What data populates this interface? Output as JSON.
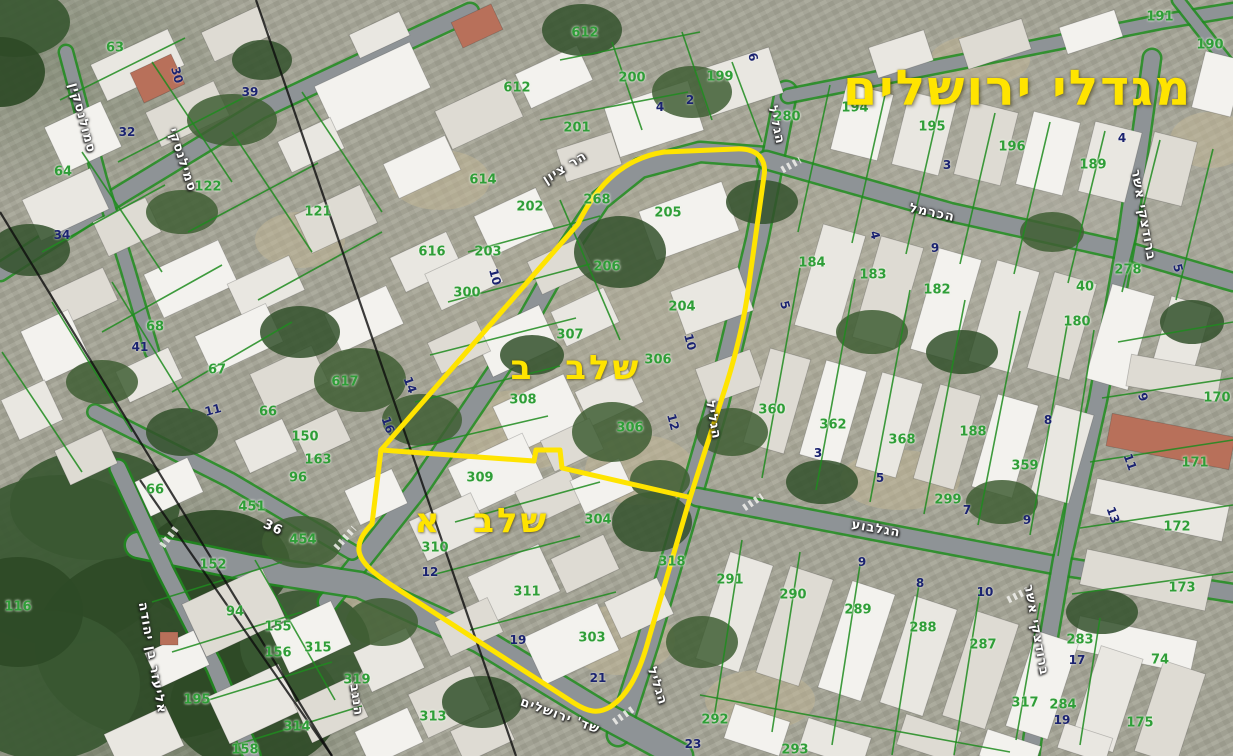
{
  "title": {
    "text": "מגדלי ירושלים"
  },
  "phase_labels": [
    {
      "text": "שלב ב",
      "x": 576,
      "y": 368
    },
    {
      "text": "שלב א",
      "x": 482,
      "y": 521
    }
  ],
  "street_labels": [
    {
      "text": "הר ציון",
      "x": 565,
      "y": 168,
      "rot": -32
    },
    {
      "text": "הגליל",
      "x": 776,
      "y": 125,
      "rot": 78
    },
    {
      "text": "הגליל",
      "x": 713,
      "y": 420,
      "rot": 80
    },
    {
      "text": "הגליל",
      "x": 657,
      "y": 686,
      "rot": 72
    },
    {
      "text": "הכרמל",
      "x": 932,
      "y": 213,
      "rot": 12
    },
    {
      "text": "הגלבוע",
      "x": 876,
      "y": 529,
      "rot": 10
    },
    {
      "text": "סמילנסקי",
      "x": 182,
      "y": 160,
      "rot": 72
    },
    {
      "text": "סמולנסקין",
      "x": 82,
      "y": 118,
      "rot": 75
    },
    {
      "text": "אליעזר בן יהודה",
      "x": 152,
      "y": 658,
      "rot": 80
    },
    {
      "text": "שד' ירושלים",
      "x": 560,
      "y": 716,
      "rot": 20
    },
    {
      "text": "הנגב",
      "x": 356,
      "y": 700,
      "rot": 82
    },
    {
      "text": "ברודצקי אשר",
      "x": 1143,
      "y": 215,
      "rot": 80
    },
    {
      "text": "ברודצקי אשר",
      "x": 1036,
      "y": 630,
      "rot": 80
    },
    {
      "text": "36",
      "x": 273,
      "y": 528,
      "rot": 25
    }
  ],
  "parcel_numbers": [
    {
      "text": "63",
      "x": 115,
      "y": 48
    },
    {
      "text": "64",
      "x": 63,
      "y": 172
    },
    {
      "text": "122",
      "x": 208,
      "y": 187
    },
    {
      "text": "121",
      "x": 318,
      "y": 212
    },
    {
      "text": "68",
      "x": 155,
      "y": 327
    },
    {
      "text": "67",
      "x": 217,
      "y": 370
    },
    {
      "text": "66",
      "x": 268,
      "y": 412
    },
    {
      "text": "66",
      "x": 155,
      "y": 490
    },
    {
      "text": "150",
      "x": 305,
      "y": 437
    },
    {
      "text": "617",
      "x": 345,
      "y": 382
    },
    {
      "text": "163",
      "x": 318,
      "y": 460
    },
    {
      "text": "96",
      "x": 298,
      "y": 478
    },
    {
      "text": "152",
      "x": 213,
      "y": 565
    },
    {
      "text": "116",
      "x": 18,
      "y": 607
    },
    {
      "text": "94",
      "x": 235,
      "y": 612
    },
    {
      "text": "155",
      "x": 278,
      "y": 627
    },
    {
      "text": "156",
      "x": 278,
      "y": 653
    },
    {
      "text": "195",
      "x": 197,
      "y": 700
    },
    {
      "text": "315",
      "x": 318,
      "y": 648
    },
    {
      "text": "314",
      "x": 297,
      "y": 727
    },
    {
      "text": "313",
      "x": 433,
      "y": 717
    },
    {
      "text": "319",
      "x": 357,
      "y": 680
    },
    {
      "text": "318",
      "x": 672,
      "y": 562
    },
    {
      "text": "158",
      "x": 245,
      "y": 750
    },
    {
      "text": "451",
      "x": 252,
      "y": 507
    },
    {
      "text": "454",
      "x": 303,
      "y": 540
    },
    {
      "text": "612",
      "x": 585,
      "y": 33
    },
    {
      "text": "612",
      "x": 517,
      "y": 88
    },
    {
      "text": "200",
      "x": 632,
      "y": 78
    },
    {
      "text": "199",
      "x": 720,
      "y": 77
    },
    {
      "text": "201",
      "x": 577,
      "y": 128
    },
    {
      "text": "280",
      "x": 787,
      "y": 117
    },
    {
      "text": "194",
      "x": 855,
      "y": 108
    },
    {
      "text": "195",
      "x": 932,
      "y": 127
    },
    {
      "text": "196",
      "x": 1012,
      "y": 147
    },
    {
      "text": "189",
      "x": 1093,
      "y": 165
    },
    {
      "text": "191",
      "x": 1160,
      "y": 17
    },
    {
      "text": "190",
      "x": 1210,
      "y": 45
    },
    {
      "text": "614",
      "x": 483,
      "y": 180
    },
    {
      "text": "202",
      "x": 530,
      "y": 207
    },
    {
      "text": "268",
      "x": 597,
      "y": 200
    },
    {
      "text": "205",
      "x": 668,
      "y": 213
    },
    {
      "text": "616",
      "x": 432,
      "y": 252
    },
    {
      "text": "203",
      "x": 488,
      "y": 252
    },
    {
      "text": "206",
      "x": 607,
      "y": 267
    },
    {
      "text": "300",
      "x": 467,
      "y": 293
    },
    {
      "text": "204",
      "x": 682,
      "y": 307
    },
    {
      "text": "307",
      "x": 570,
      "y": 335
    },
    {
      "text": "306",
      "x": 658,
      "y": 360
    },
    {
      "text": "308",
      "x": 523,
      "y": 400
    },
    {
      "text": "306",
      "x": 630,
      "y": 428
    },
    {
      "text": "309",
      "x": 480,
      "y": 478
    },
    {
      "text": "310",
      "x": 435,
      "y": 548
    },
    {
      "text": "311",
      "x": 527,
      "y": 592
    },
    {
      "text": "304",
      "x": 598,
      "y": 520
    },
    {
      "text": "303",
      "x": 592,
      "y": 638
    },
    {
      "text": "360",
      "x": 772,
      "y": 410
    },
    {
      "text": "362",
      "x": 833,
      "y": 425
    },
    {
      "text": "368",
      "x": 902,
      "y": 440
    },
    {
      "text": "188",
      "x": 973,
      "y": 432
    },
    {
      "text": "359",
      "x": 1025,
      "y": 466
    },
    {
      "text": "299",
      "x": 948,
      "y": 500
    },
    {
      "text": "184",
      "x": 812,
      "y": 263
    },
    {
      "text": "183",
      "x": 873,
      "y": 275
    },
    {
      "text": "182",
      "x": 937,
      "y": 290
    },
    {
      "text": "180",
      "x": 1077,
      "y": 322
    },
    {
      "text": "40",
      "x": 1085,
      "y": 287
    },
    {
      "text": "278",
      "x": 1128,
      "y": 270
    },
    {
      "text": "170",
      "x": 1217,
      "y": 398
    },
    {
      "text": "171",
      "x": 1195,
      "y": 463
    },
    {
      "text": "172",
      "x": 1177,
      "y": 527
    },
    {
      "text": "173",
      "x": 1182,
      "y": 588
    },
    {
      "text": "291",
      "x": 730,
      "y": 580
    },
    {
      "text": "290",
      "x": 793,
      "y": 595
    },
    {
      "text": "289",
      "x": 858,
      "y": 610
    },
    {
      "text": "288",
      "x": 923,
      "y": 628
    },
    {
      "text": "287",
      "x": 983,
      "y": 645
    },
    {
      "text": "292",
      "x": 715,
      "y": 720
    },
    {
      "text": "293",
      "x": 795,
      "y": 750
    },
    {
      "text": "317",
      "x": 1025,
      "y": 703
    },
    {
      "text": "284",
      "x": 1063,
      "y": 705
    },
    {
      "text": "283",
      "x": 1080,
      "y": 640
    },
    {
      "text": "74",
      "x": 1160,
      "y": 660
    },
    {
      "text": "175",
      "x": 1140,
      "y": 723
    }
  ],
  "house_numbers": [
    {
      "text": "30",
      "x": 177,
      "y": 75,
      "rot": 75
    },
    {
      "text": "32",
      "x": 127,
      "y": 132
    },
    {
      "text": "34",
      "x": 62,
      "y": 235
    },
    {
      "text": "39",
      "x": 250,
      "y": 92
    },
    {
      "text": "41",
      "x": 140,
      "y": 347
    },
    {
      "text": "11",
      "x": 213,
      "y": 410,
      "rot": -15
    },
    {
      "text": "14",
      "x": 410,
      "y": 385,
      "rot": 70
    },
    {
      "text": "16",
      "x": 388,
      "y": 425,
      "rot": 70
    },
    {
      "text": "4",
      "x": 660,
      "y": 107
    },
    {
      "text": "2",
      "x": 690,
      "y": 100
    },
    {
      "text": "6",
      "x": 753,
      "y": 57,
      "rot": 75
    },
    {
      "text": "10",
      "x": 495,
      "y": 277,
      "rot": 75
    },
    {
      "text": "10",
      "x": 690,
      "y": 342,
      "rot": 75
    },
    {
      "text": "12",
      "x": 673,
      "y": 422,
      "rot": 75
    },
    {
      "text": "12",
      "x": 430,
      "y": 572
    },
    {
      "text": "19",
      "x": 518,
      "y": 640
    },
    {
      "text": "21",
      "x": 598,
      "y": 678
    },
    {
      "text": "23",
      "x": 693,
      "y": 744
    },
    {
      "text": "4",
      "x": 875,
      "y": 235,
      "rot": 75
    },
    {
      "text": "5",
      "x": 785,
      "y": 305,
      "rot": 75
    },
    {
      "text": "3",
      "x": 947,
      "y": 165
    },
    {
      "text": "9",
      "x": 935,
      "y": 248
    },
    {
      "text": "4",
      "x": 1122,
      "y": 138
    },
    {
      "text": "5",
      "x": 1178,
      "y": 268,
      "rot": 75
    },
    {
      "text": "8",
      "x": 1048,
      "y": 420
    },
    {
      "text": "3",
      "x": 818,
      "y": 453
    },
    {
      "text": "5",
      "x": 880,
      "y": 478
    },
    {
      "text": "7",
      "x": 967,
      "y": 510
    },
    {
      "text": "9",
      "x": 1027,
      "y": 520
    },
    {
      "text": "9",
      "x": 862,
      "y": 562
    },
    {
      "text": "8",
      "x": 920,
      "y": 583
    },
    {
      "text": "10",
      "x": 985,
      "y": 592
    },
    {
      "text": "11",
      "x": 1130,
      "y": 462,
      "rot": 70
    },
    {
      "text": "13",
      "x": 1113,
      "y": 515,
      "rot": 70
    },
    {
      "text": "9",
      "x": 1143,
      "y": 397,
      "rot": 70
    },
    {
      "text": "17",
      "x": 1077,
      "y": 660
    },
    {
      "text": "19",
      "x": 1062,
      "y": 720
    }
  ],
  "colors": {
    "accent_yellow": "#ffe400",
    "cadastral_green": "#1f8c1f",
    "parcel_text_green": "#2f9e38",
    "house_text_blue": "#1b2370",
    "street_text_white": "#ffffff",
    "road_gray": "#8e9396"
  }
}
